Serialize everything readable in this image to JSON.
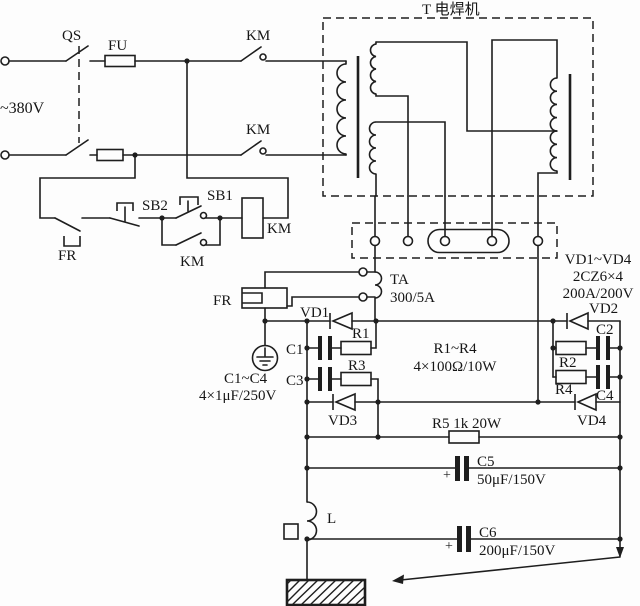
{
  "diagram_title": "T 电焊机",
  "colors": {
    "ink": "#1e1e1e",
    "background": "#fdfdfd"
  },
  "labels": {
    "voltage": "~380V",
    "qs": "QS",
    "fu": "FU",
    "km_contact_top": "KM",
    "km_contact_bottom": "KM",
    "fr_contact": "FR",
    "sb2": "SB2",
    "sb1": "SB1",
    "km_aux": "KM",
    "km_coil": "KM",
    "fr_heater": "FR",
    "transformer_title": "T 电焊机",
    "ta_name": "TA",
    "ta_ratio": "300/5A",
    "diode_block_line1": "VD1~VD4",
    "diode_block_line2": "2CZ6×4",
    "diode_block_line3": "200A/200V",
    "vd1": "VD1",
    "vd2": "VD2",
    "vd3": "VD3",
    "vd4": "VD4",
    "r1": "R1",
    "r2": "R2",
    "r3": "R3",
    "r4": "R4",
    "c1": "C1",
    "c2": "C2",
    "c3": "C3",
    "c4": "C4",
    "r_group_line1": "R1~R4",
    "r_group_line2": "4×100Ω/10W",
    "c_group_line1": "C1~C4",
    "c_group_line2": "4×1μF/250V",
    "r5": "R5 1k  20W",
    "c5_plus": "+",
    "c5_name": "C5",
    "c5_value": "50μF/150V",
    "c6_plus": "+",
    "c6_name": "C6",
    "c6_value": "200μF/150V",
    "inductor": "L"
  }
}
